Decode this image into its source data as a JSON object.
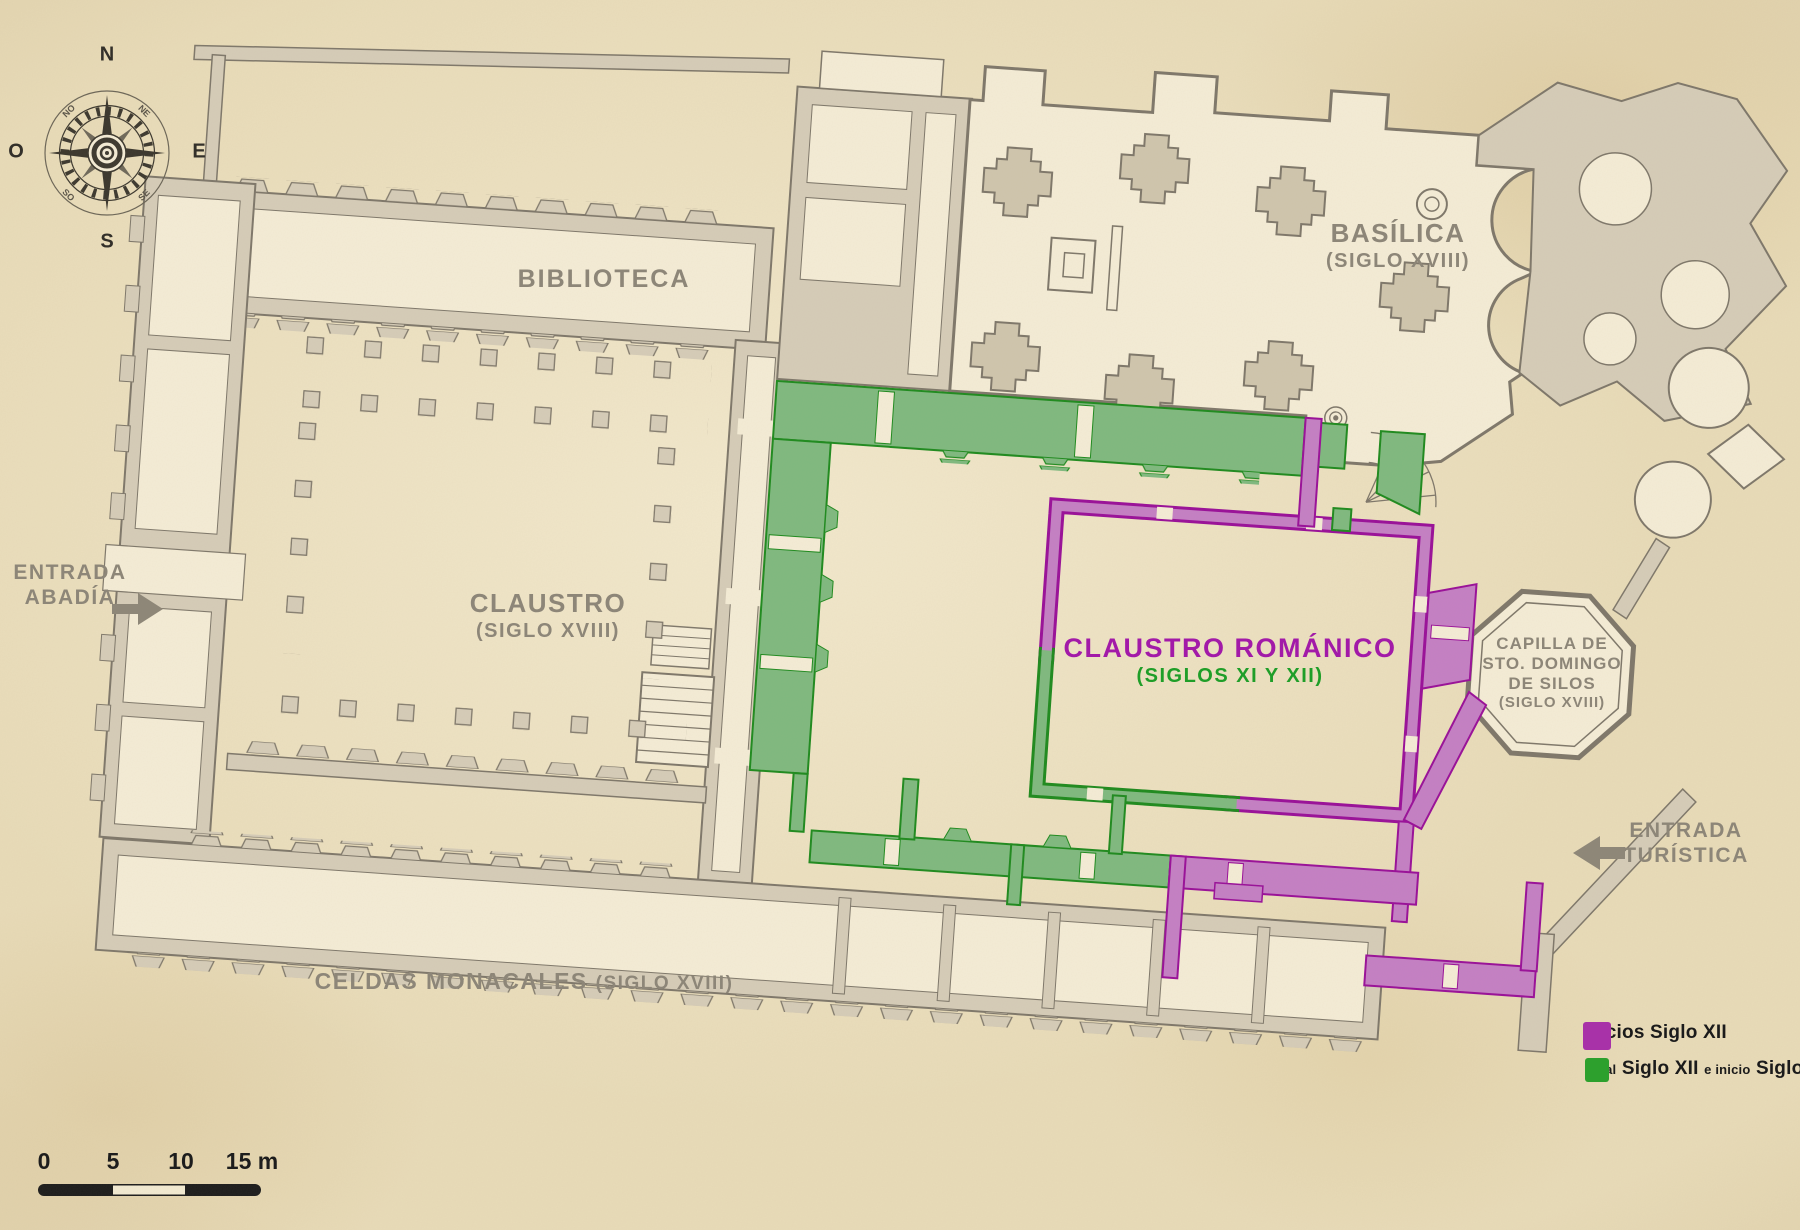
{
  "labels": {
    "biblioteca": "BIBLIOTECA",
    "basilica": {
      "name": "BASÍLICA",
      "era": "(SIGLO XVIII)"
    },
    "claustro": {
      "name": "CLAUSTRO",
      "era": "(SIGLO XVIII)"
    },
    "claustro_romanico": {
      "name": "CLAUSTRO ROMÁNICO",
      "era": "(SIGLOS XI Y XII)"
    },
    "capilla": {
      "line1": "CAPILLA DE",
      "line2": "STO. DOMINGO",
      "line3": "DE SILOS",
      "era": "(SIGLO XVIII)"
    },
    "celdas": {
      "name": "CELDAS MONACALES",
      "era": "(SIGLO XVIII)"
    },
    "entrada_abadia": {
      "line1": "ENTRADA",
      "line2": "ABADÍA"
    },
    "entrada_turistica": {
      "line1": "ENTRADA",
      "line2": "TURÍSTICA"
    }
  },
  "compass": {
    "north": "N",
    "south": "S",
    "east": "E",
    "west": "O",
    "northwest": "NO",
    "northeast": "NE",
    "southwest": "SO",
    "southeast": "SE"
  },
  "legend": {
    "items": [
      {
        "swatch_color": "#a832a8",
        "label": "Inicios Siglo XII"
      },
      {
        "swatch_color": "#2da02d",
        "parts": [
          {
            "text": "Final"
          },
          {
            "text": "Siglo XII"
          },
          {
            "text": "e inicio"
          },
          {
            "text": "Siglo XIII"
          }
        ]
      }
    ]
  },
  "scale_bar": {
    "ticks": [
      "0",
      "5",
      "10",
      "15 m"
    ]
  },
  "colors": {
    "early_12th_purple": "#a832a8",
    "late_12th_13th_green": "#2da02d",
    "walls_18th_gray": "#8d8678",
    "paper": "#e8dbb8"
  }
}
